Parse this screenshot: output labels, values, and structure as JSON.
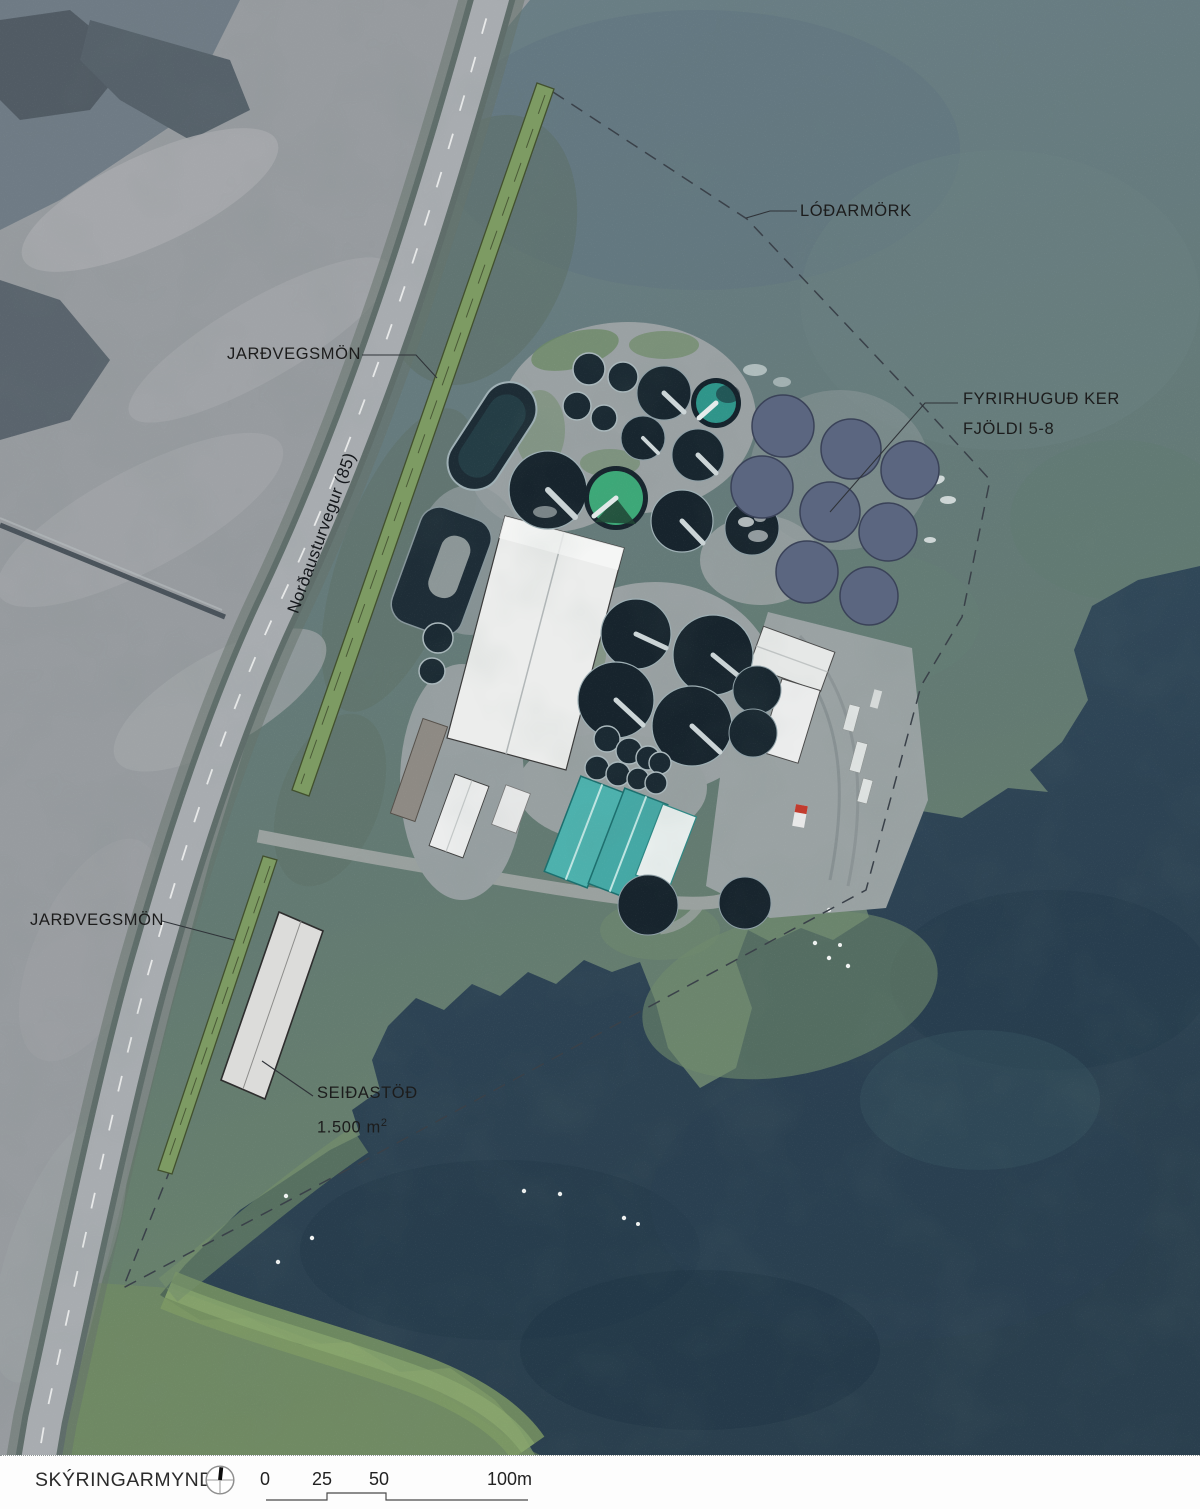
{
  "map": {
    "labels": {
      "lot_boundary": "LÓÐARMÖRK",
      "soil_berm_top": "JARÐVEGSMÖN",
      "soil_berm_bottom": "JARÐVEGSMÖN",
      "road": "Norðausturvegur (85)",
      "proposed_tanks_line1": "FYRIRHUGUÐ KER",
      "proposed_tanks_line2": "FJÖLDI 5-8",
      "smolt_station": "SEIÐASTÖÐ",
      "smolt_station_area": "1.500 m",
      "smolt_station_area_exponent": "2"
    },
    "proposed_tank_count": 8,
    "colors": {
      "soil_berm_green": "#7d9b63",
      "soil_berm_outline": "#42502e",
      "proposed_tank_fill": "#5b6680",
      "proposed_tank_outline": "#3a4258",
      "smolt_station_fill": "#dcdcda",
      "smolt_station_outline": "#2e2e2e",
      "boundary_line": "#3a4149",
      "label_text": "#1c1c1c"
    }
  },
  "legend": {
    "title": "SKÝRINGARMYND",
    "scale_ticks": [
      "0",
      "25",
      "50"
    ],
    "scale_end_label": "100m"
  }
}
